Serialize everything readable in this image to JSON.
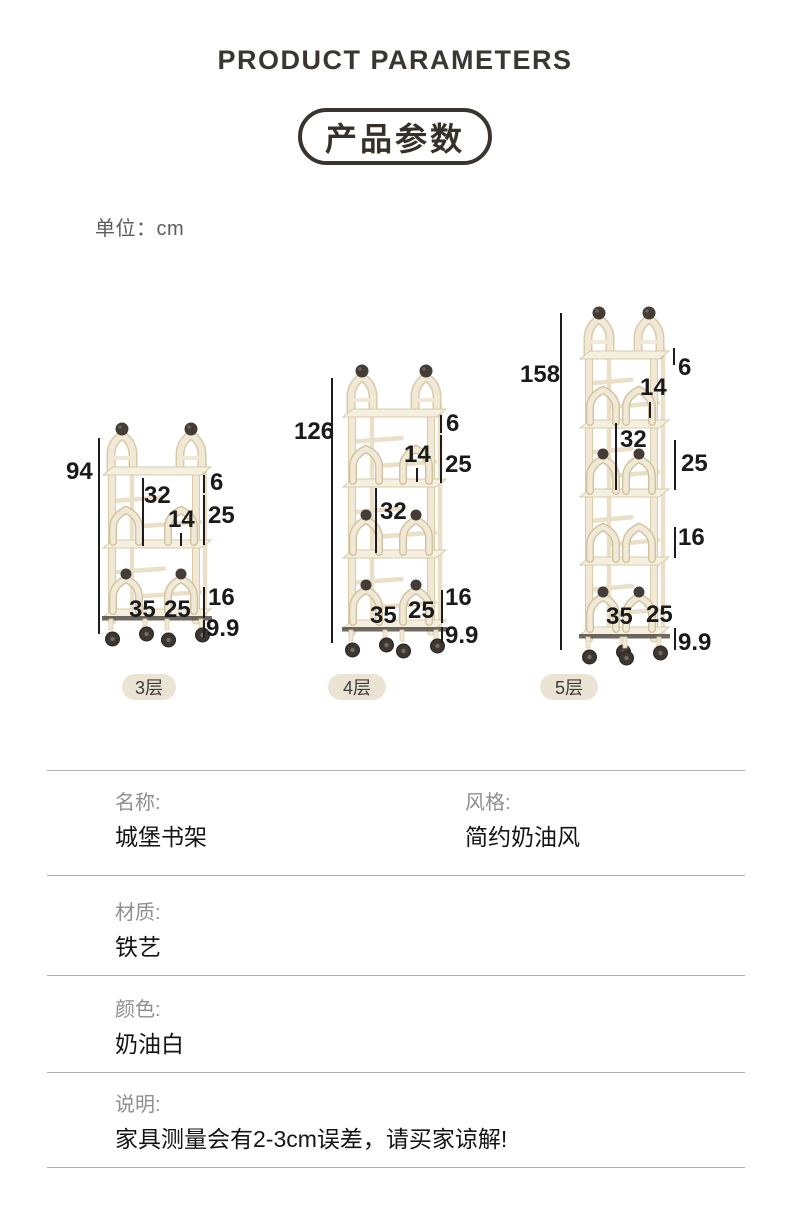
{
  "header": {
    "title_en": "PRODUCT PARAMETERS",
    "title_zh": "产品参数",
    "unit": "单位：cm"
  },
  "shelves": [
    {
      "badge": "3层",
      "tiers": 3,
      "dims": {
        "total": "94",
        "top_lip": "6",
        "upper_gap": "25",
        "arch_height": "14",
        "tier_gap": "32",
        "lower_gap": "16",
        "wheel_height": "9.9",
        "depth": "35",
        "width": "25"
      }
    },
    {
      "badge": "4层",
      "tiers": 4,
      "dims": {
        "total": "126",
        "top_lip": "6",
        "upper_gap": "25",
        "arch_height": "14",
        "tier_gap": "32",
        "lower_gap": "16",
        "wheel_height": "9.9",
        "depth": "35",
        "width": "25"
      }
    },
    {
      "badge": "5层",
      "tiers": 5,
      "dims": {
        "total": "158",
        "top_lip": "6",
        "upper_gap": "25",
        "arch_height": "14",
        "tier_gap": "32",
        "lower_gap": "16",
        "wheel_height": "9.9",
        "depth": "35",
        "width": "25"
      }
    }
  ],
  "specs": [
    {
      "label": "名称:",
      "value": "城堡书架",
      "label2": "风格:",
      "value2": "简约奶油风"
    },
    {
      "label": "材质:",
      "value": "铁艺"
    },
    {
      "label": "颜色:",
      "value": "奶油白"
    },
    {
      "label": "说明:",
      "value": "家具测量会有2-3cm误差，请买家谅解!"
    }
  ],
  "colors": {
    "ink": "#39342f",
    "cream": "#f1e9d6",
    "cream_edge": "#d7cba8",
    "ball_dark": "#443d37",
    "tier_badge_bg": "#ebe4d5",
    "label_gray": "#8f8f8f",
    "value_dark": "#141414",
    "divider": "#b0b0b0"
  }
}
